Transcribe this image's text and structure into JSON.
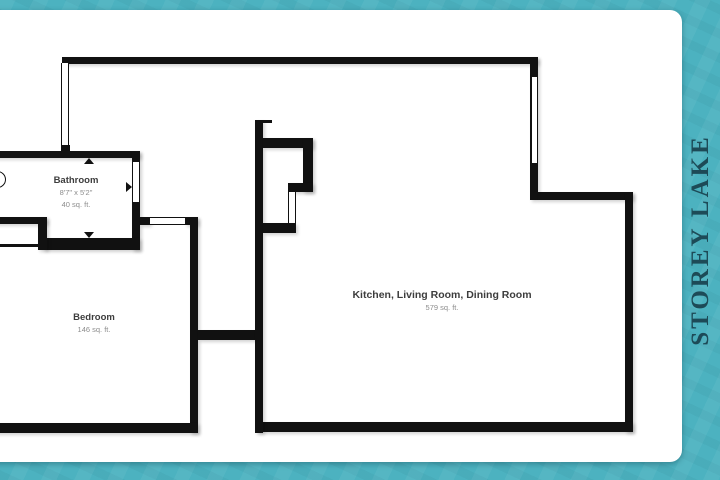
{
  "branding": {
    "name": "STOREY LAKE"
  },
  "floorplan": {
    "rooms": [
      {
        "name": "Bathroom",
        "dimensions": "8'7\" x 5'2\"",
        "area": "40 sq. ft."
      },
      {
        "name": "Bedroom",
        "area": "146 sq. ft."
      },
      {
        "name": "Kitchen, Living Room, Dining Room",
        "area": "579 sq. ft."
      }
    ]
  },
  "colors": {
    "frame_teal": "#4cb2c0",
    "brand_text": "#1d4a57",
    "walls": "#111111",
    "card_background": "#ffffff"
  },
  "icons": {
    "direction_markers": "small black triangle markers on bathroom walls",
    "door_arc": "quarter-circle door swing arc at left edge"
  }
}
